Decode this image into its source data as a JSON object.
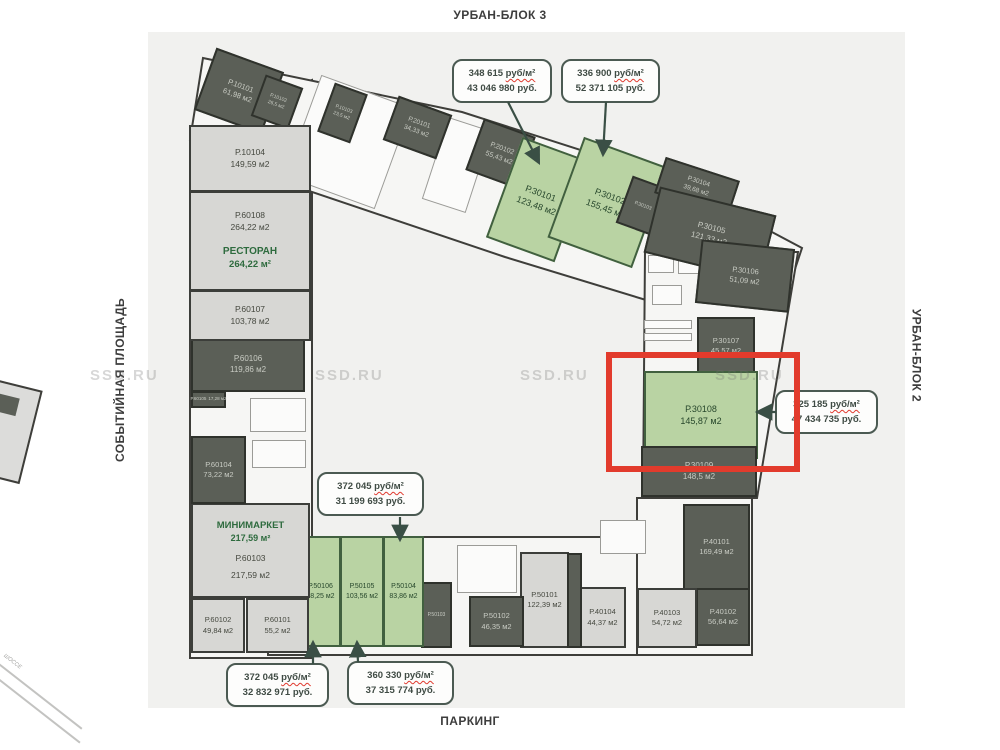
{
  "labels": {
    "top": "УРБАН-БЛОК 3",
    "right": "УРБАН-БЛОК 2",
    "bottom": "ПАРКИНГ",
    "left": "СОБЫТИЙНАЯ ПЛОЩАДЬ",
    "road": "ШОССЕ"
  },
  "watermark": {
    "text": "SSD.RU"
  },
  "colors": {
    "available_green": "#b9d3a3",
    "occupied_dark": "#5b5f57",
    "common_light": "#d7d7d4",
    "highlight_red": "#e23b2c",
    "callout_border": "#4b5a52",
    "arrow": "#3a4f45",
    "shop_text_green": "#2e6b3e"
  },
  "callouts": [
    {
      "price": "348 615",
      "per": "руб/м²",
      "total": "43 046 980 руб.",
      "target": "Р.30101"
    },
    {
      "price": "336 900",
      "per": "руб/м²",
      "total": "52 371 105 руб.",
      "target": "Р.30102"
    },
    {
      "price": "372 045",
      "per": "руб/м²",
      "total": "31 199 693 руб.",
      "target": "Р.50104"
    },
    {
      "price": "372 045",
      "per": "руб/м²",
      "total": "32 832 971 руб.",
      "target": "Р.50106"
    },
    {
      "price": "360 330",
      "per": "руб/м²",
      "total": "37 315 774 руб.",
      "target": "Р.50105"
    },
    {
      "price": "325 185",
      "per": "руб/м²",
      "total": "47 434 735 руб.",
      "target": "Р.30108"
    }
  ],
  "units": [
    {
      "id": "Р.10101",
      "area": "61,98 м2",
      "status": "occupied"
    },
    {
      "id": "Р.10102",
      "area": "26,5 м2",
      "status": "occupied"
    },
    {
      "id": "Р.10103",
      "area": "23,5 м2",
      "status": "occupied"
    },
    {
      "id": "Р.20101",
      "area": "34,33 м2",
      "status": "occupied"
    },
    {
      "id": "Р.20102",
      "area": "55,43 м2",
      "status": "occupied"
    },
    {
      "id": "Р.30101",
      "area": "123,48 м2",
      "status": "available"
    },
    {
      "id": "Р.30102",
      "area": "155,45 м2",
      "status": "available"
    },
    {
      "id": "Р.30103",
      "area": "",
      "status": "occupied"
    },
    {
      "id": "Р.30104",
      "area": "39,68 м2",
      "status": "occupied"
    },
    {
      "id": "Р.30105",
      "area": "121,33 м2",
      "status": "occupied"
    },
    {
      "id": "Р.30106",
      "area": "51,09 м2",
      "status": "occupied"
    },
    {
      "id": "Р.30107",
      "area": "45,57 м2",
      "status": "occupied"
    },
    {
      "id": "Р.30108",
      "area": "145,87 м2",
      "status": "available",
      "highlighted": true
    },
    {
      "id": "Р.30109",
      "area": "148,5 м2",
      "status": "occupied"
    },
    {
      "id": "Р.40101",
      "area": "169,49 м2",
      "status": "occupied"
    },
    {
      "id": "Р.40102",
      "area": "56,64 м2",
      "status": "occupied"
    },
    {
      "id": "Р.40103",
      "area": "54,72 м2",
      "status": "common"
    },
    {
      "id": "Р.40104",
      "area": "44,37 м2",
      "status": "common"
    },
    {
      "id": "Р.50101",
      "area": "122,39 м2",
      "status": "common"
    },
    {
      "id": "Р.50102",
      "area": "46,35 м2",
      "status": "occupied"
    },
    {
      "id": "Р.50103",
      "area": "",
      "status": "occupied"
    },
    {
      "id": "Р.50104",
      "area": "83,86 м2",
      "status": "available"
    },
    {
      "id": "Р.50105",
      "area": "103,56 м2",
      "status": "available"
    },
    {
      "id": "Р.50106",
      "area": "88,25 м2",
      "status": "available"
    },
    {
      "id": "Р.60101",
      "area": "55,2 м2",
      "status": "common"
    },
    {
      "id": "Р.60102",
      "area": "49,84 м2",
      "status": "common"
    },
    {
      "id": "Р.60103",
      "area": "217,59 м2",
      "status": "common",
      "name": "МИНИМАРКЕТ",
      "name_area": "217,59 м²"
    },
    {
      "id": "Р.60104",
      "area": "73,22 м2",
      "status": "occupied"
    },
    {
      "id": "Р.60105",
      "area": "17,28 м2",
      "status": "occupied"
    },
    {
      "id": "Р.60106",
      "area": "119,86 м2",
      "status": "occupied"
    },
    {
      "id": "Р.60107",
      "area": "103,78 м2",
      "status": "common"
    },
    {
      "id": "Р.60108",
      "area": "264,22 м2",
      "status": "common",
      "name": "РЕСТОРАН",
      "name_area": "264,22 м²"
    },
    {
      "id": "Р.10104",
      "area": "149,59 м2",
      "status": "common"
    }
  ]
}
